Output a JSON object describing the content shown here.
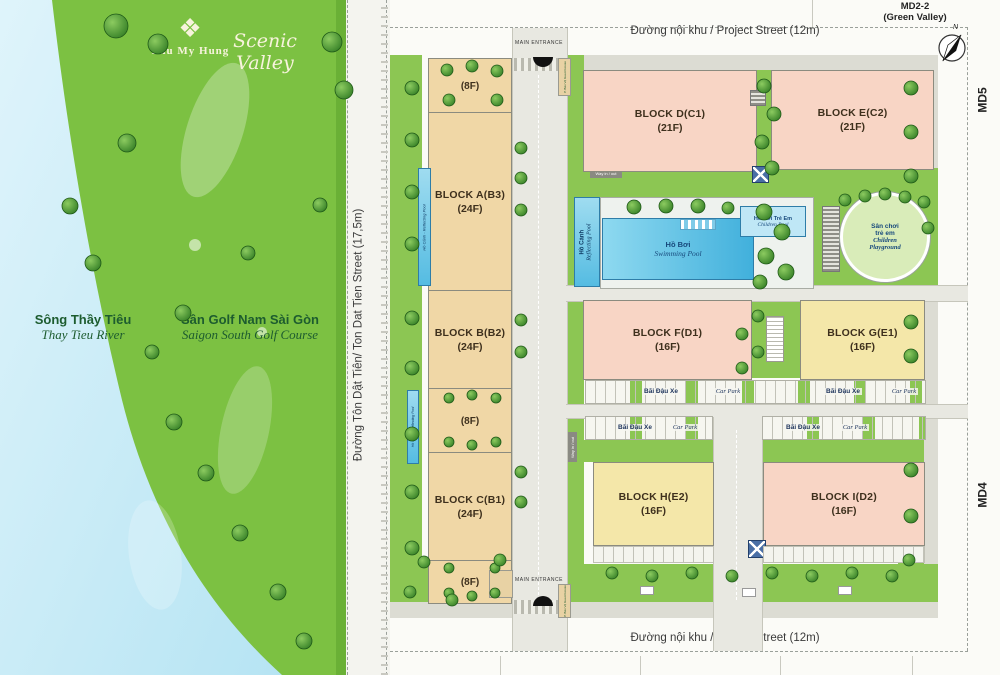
{
  "left_panel": {
    "brand": "Phu My Hung",
    "project": "Scenic Valley",
    "river_vi": "Sông Thầy Tiêu",
    "river_en": "Thay Tieu River",
    "golf_vi": "Sân Golf Nam Sài Gòn",
    "golf_en": "Saigon South Golf Course"
  },
  "streets": {
    "top": "Đường nội khu / Project Street (12m)",
    "bottom": "Đường nội khu / Project Street (12m)",
    "left": "Đường Tôn Dật Tiên/ Ton Dat Tien Street (17,5m)",
    "right": "Đường nội khu / Project Street (12m)"
  },
  "edge": {
    "lot_top_right": "MD2-2",
    "lot_top_right_sub": "(Green Valley)",
    "lot_right_upper": "MD5",
    "lot_right_lower": "MD4",
    "compass_n": "N"
  },
  "entrances": {
    "main_top": "MAIN ENTRANCE",
    "main_bottom": "MAIN ENTRANCE",
    "guard": "P. Bảo Vệ  Guard House",
    "way": "Way in / out"
  },
  "blocks": [
    {
      "name": "BLOCK A(B3)",
      "floors": "(24F)"
    },
    {
      "name": "BLOCK B(B2)",
      "floors": "(24F)"
    },
    {
      "name": "BLOCK C(B1)",
      "floors": "(24F)"
    },
    {
      "name": "BLOCK D(C1)",
      "floors": "(21F)"
    },
    {
      "name": "BLOCK E(C2)",
      "floors": "(21F)"
    },
    {
      "name": "BLOCK F(D1)",
      "floors": "(16F)"
    },
    {
      "name": "BLOCK G(E1)",
      "floors": "(16F)"
    },
    {
      "name": "BLOCK H(E2)",
      "floors": "(16F)"
    },
    {
      "name": "BLOCK I(D2)",
      "floors": "(16F)"
    }
  ],
  "low_rise": {
    "floors": "(8F)"
  },
  "amenities": {
    "reflecting_vi": "Hồ Cảnh",
    "reflecting_en": "Reflecting Pool",
    "reflecting_strip": "Hồ Cảnh - Reflecting Pool",
    "swimming_vi": "Hồ Bơi",
    "swimming_en": "Swimming Pool",
    "children_pool_vi": "Hồ Bơi Trẻ Em",
    "children_pool_en": "Children Pool",
    "playground_vi1": "Sân chơi",
    "playground_vi2": "trẻ em",
    "playground_en1": "Children",
    "playground_en2": "Playground"
  },
  "car_park": {
    "vi": "Bãi Đậu Xe",
    "en": "Car Park"
  },
  "colors": {
    "golf_green": "#7cc142",
    "river_blue": "#c9ecf7",
    "tower_tan": "#f0d7a6",
    "tower_pink": "#f8d5c5",
    "tower_yellow": "#f4e7a9",
    "pool_blue": "#54bee4",
    "landscape_green": "#8cc653",
    "label_navy": "#17497c"
  }
}
